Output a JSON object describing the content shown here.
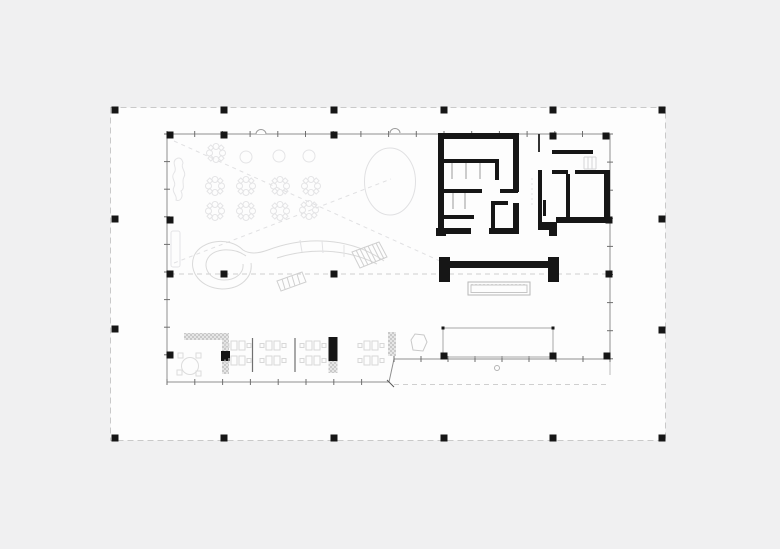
{
  "canvas": {
    "width": 780,
    "height": 549
  },
  "colors": {
    "background": "#f0f0f1",
    "sheet": "#fdfdfd",
    "sheet_border": "#c9c9c9",
    "ink": "#161616",
    "line_mid": "#8f8f8f",
    "line_soft": "#b5b5b5",
    "line_light": "#d9d9d9",
    "line_faint": "#e4e4e6",
    "hatch_dark": "#c9c9c9",
    "hatch_light": "#e6e6e6"
  },
  "sheet": {
    "x": 110.5,
    "y": 107.5,
    "w": 555,
    "h": 333
  },
  "grid": {
    "sheet_dots": [
      [
        115,
        110
      ],
      [
        224,
        110
      ],
      [
        334,
        110
      ],
      [
        444,
        110
      ],
      [
        553,
        110
      ],
      [
        662,
        110
      ],
      [
        115,
        219
      ],
      [
        662,
        219
      ],
      [
        115,
        329
      ],
      [
        662,
        330
      ],
      [
        115,
        438
      ],
      [
        224,
        438
      ],
      [
        334,
        438
      ],
      [
        444,
        438
      ],
      [
        553,
        438
      ],
      [
        662,
        438
      ]
    ],
    "plan_dots": [
      [
        170,
        135
      ],
      [
        224,
        135
      ],
      [
        334,
        135
      ],
      [
        553,
        136
      ],
      [
        606,
        136
      ],
      [
        170,
        220
      ],
      [
        609,
        220
      ],
      [
        170,
        274
      ],
      [
        224,
        274
      ],
      [
        334,
        274
      ],
      [
        609,
        274
      ],
      [
        170,
        355
      ],
      [
        225,
        356
      ],
      [
        444,
        356
      ],
      [
        553,
        356
      ],
      [
        607,
        356
      ]
    ],
    "tick_lines": [
      {
        "o": "h",
        "y": 134,
        "x1": 167,
        "x2": 610,
        "step": 27.7,
        "len": 6
      },
      {
        "o": "v",
        "x": 167,
        "y1": 134,
        "y2": 382,
        "step": 27.6,
        "len": 6
      },
      {
        "o": "h",
        "y": 382,
        "x1": 167,
        "x2": 389,
        "step": 27.8,
        "len": 6
      },
      {
        "o": "h",
        "y": 359,
        "x1": 394,
        "x2": 610,
        "step": 27.0,
        "len": 6
      },
      {
        "o": "v",
        "x": 610,
        "y1": 134,
        "y2": 359,
        "step": 28.1,
        "len": 6
      }
    ]
  },
  "furniture": {
    "round_tables": [
      [
        246,
        157
      ],
      [
        279,
        156
      ],
      [
        309,
        156
      ]
    ],
    "flower_tables": [
      [
        216,
        153
      ],
      [
        215,
        186
      ],
      [
        246,
        186
      ],
      [
        280,
        186
      ],
      [
        311,
        186
      ],
      [
        215,
        211
      ],
      [
        246,
        211
      ],
      [
        280,
        211
      ],
      [
        309,
        210
      ]
    ],
    "desk_islands": [
      238,
      273,
      313,
      371
    ],
    "meeting_table": [
      190,
      366
    ]
  }
}
